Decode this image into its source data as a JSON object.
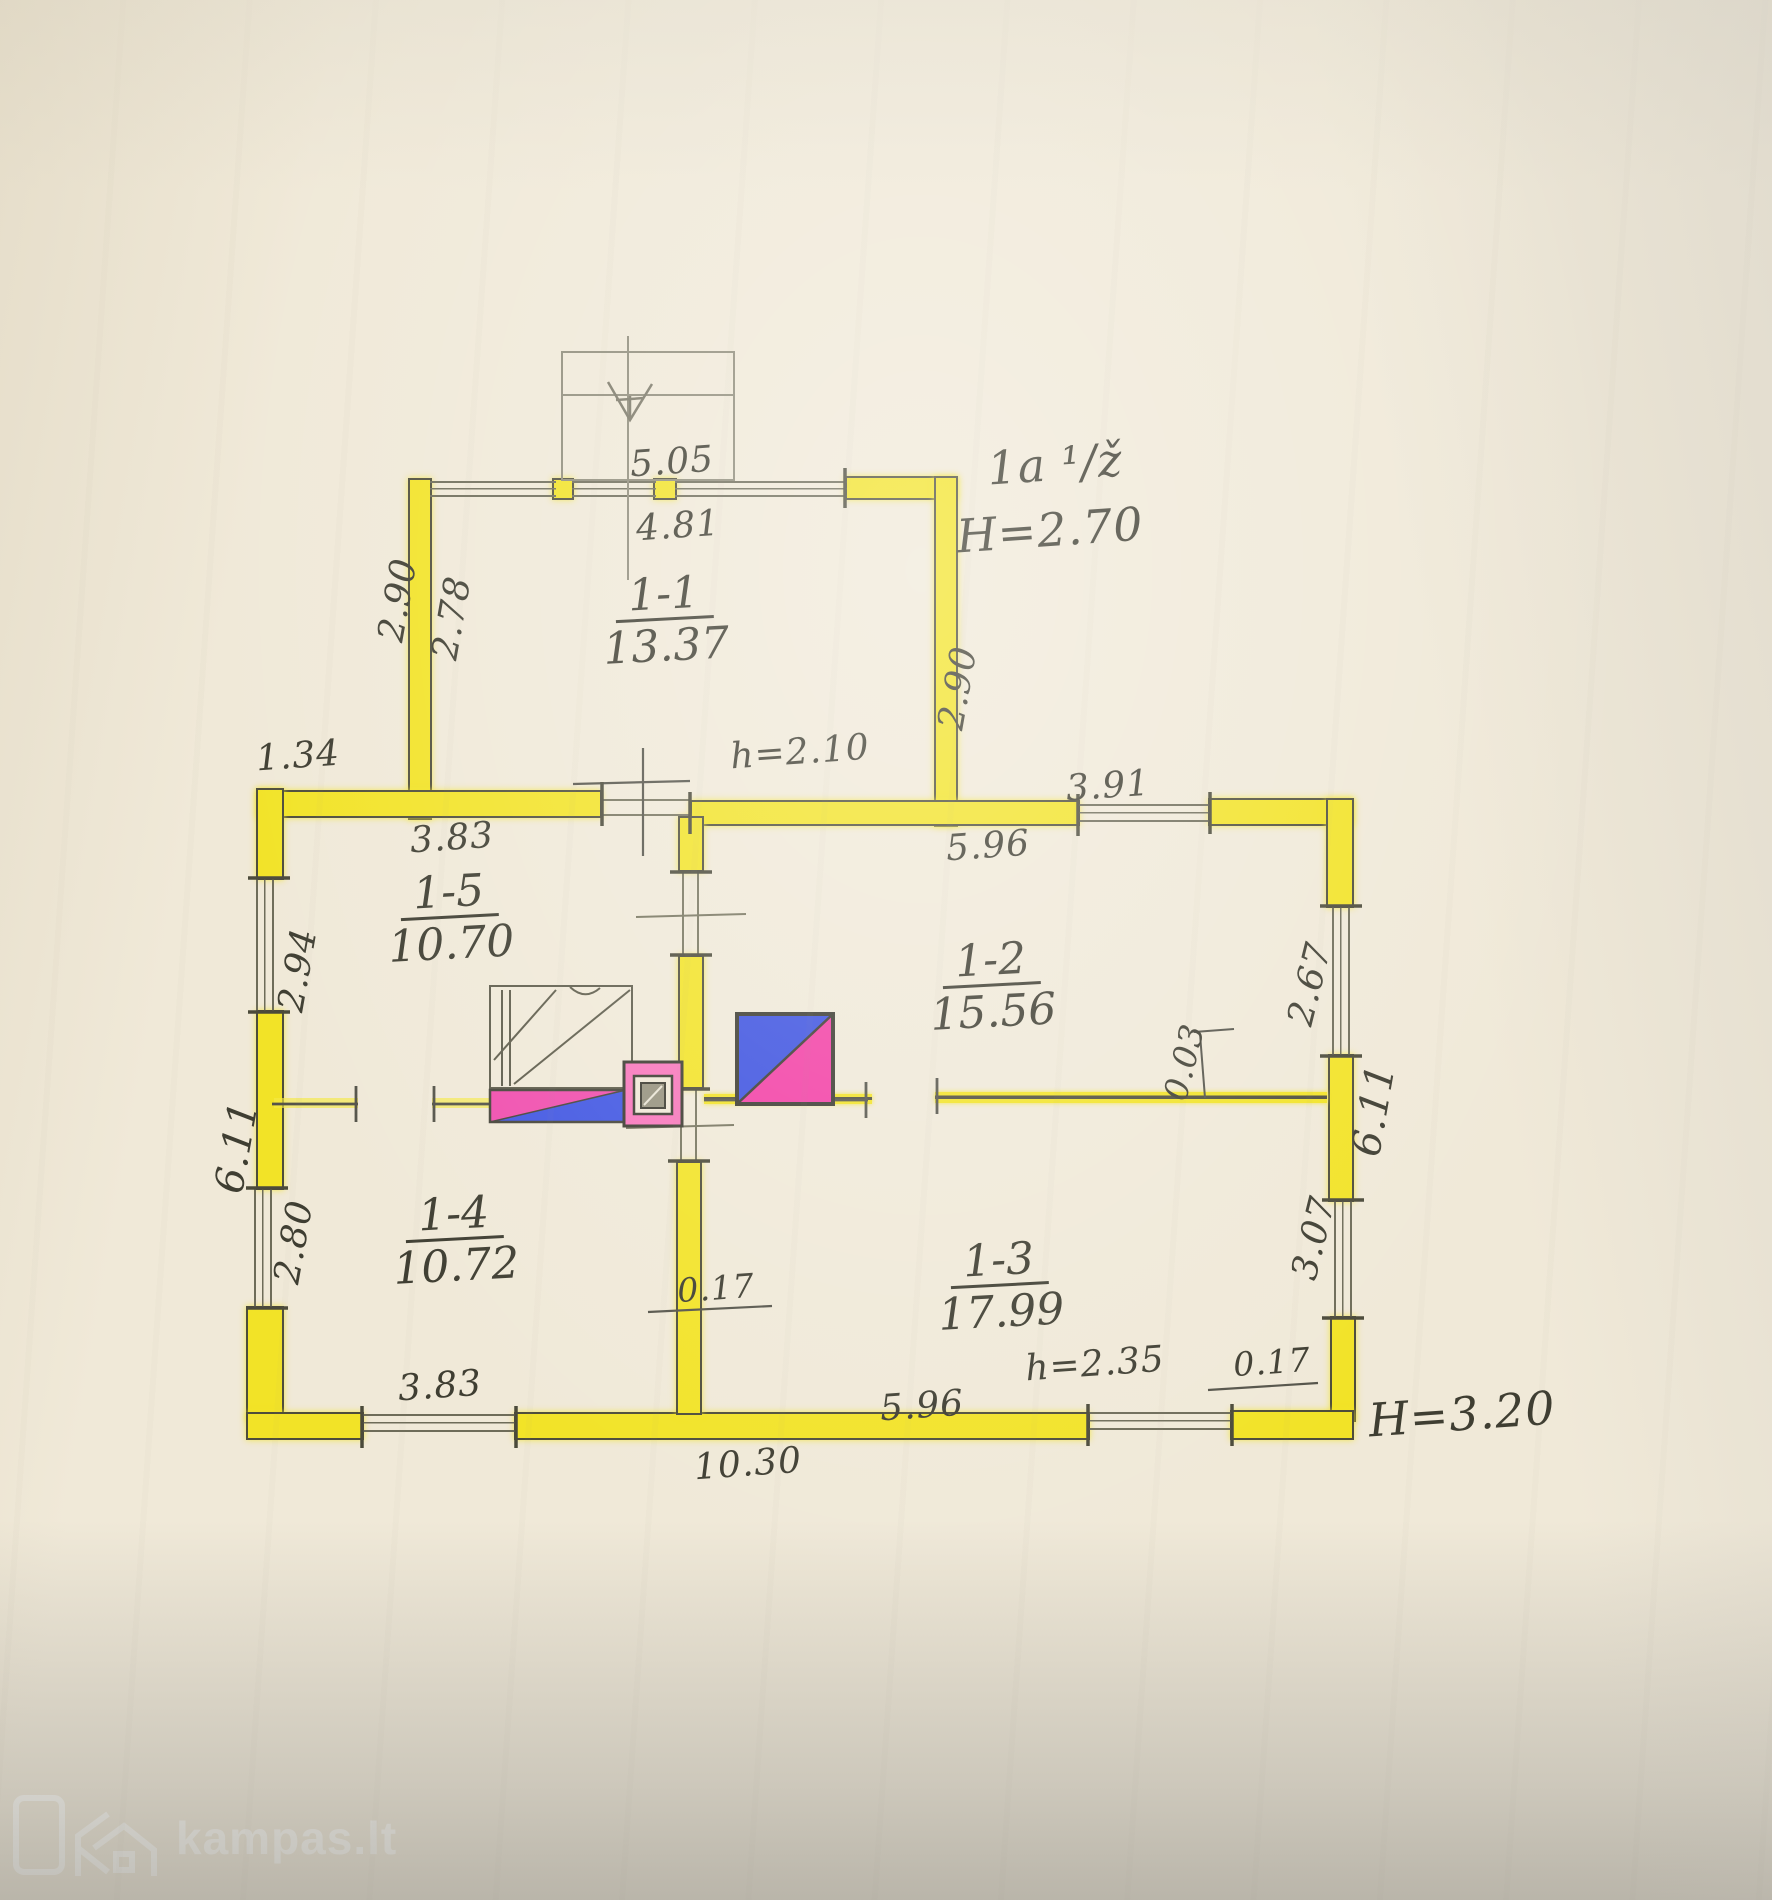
{
  "plan": {
    "building_class": "1a ¹/ž",
    "height_wing": "H=2.70",
    "height_main": "H=3.20",
    "rooms": [
      {
        "id": "1-1",
        "area": "13.37"
      },
      {
        "id": "1-5",
        "area": "10.70"
      },
      {
        "id": "1-2",
        "area": "15.56"
      },
      {
        "id": "1-4",
        "area": "10.72"
      },
      {
        "id": "1-3",
        "area": "17.99"
      }
    ],
    "dims": {
      "porch_outer": "5.05",
      "porch_inner": "4.81",
      "wing_left_outer": "2.90",
      "wing_left_inner": "2.78",
      "wing_right": "2.90",
      "offset_top_left": "1.34",
      "door_height_wing": "h=2.10",
      "window_top_right": "3.91",
      "room15_width": "3.83",
      "room12_top": "5.96",
      "window_left_top": "2.94",
      "wall_left": "6.11",
      "window_left_bottom": "2.80",
      "window_right_top": "2.67",
      "wall_right": "6.11",
      "window_right_bottom": "3.07",
      "partition_thickness": "0.03",
      "wall_thickness_mid": "0.17",
      "wall_thickness_corner": "0.17",
      "door_height_main": "h=2.35",
      "room13_bottom": "5.96",
      "room14_width": "3.83",
      "total_width": "10.30"
    }
  },
  "watermark": {
    "logo": "kampas.lt"
  }
}
